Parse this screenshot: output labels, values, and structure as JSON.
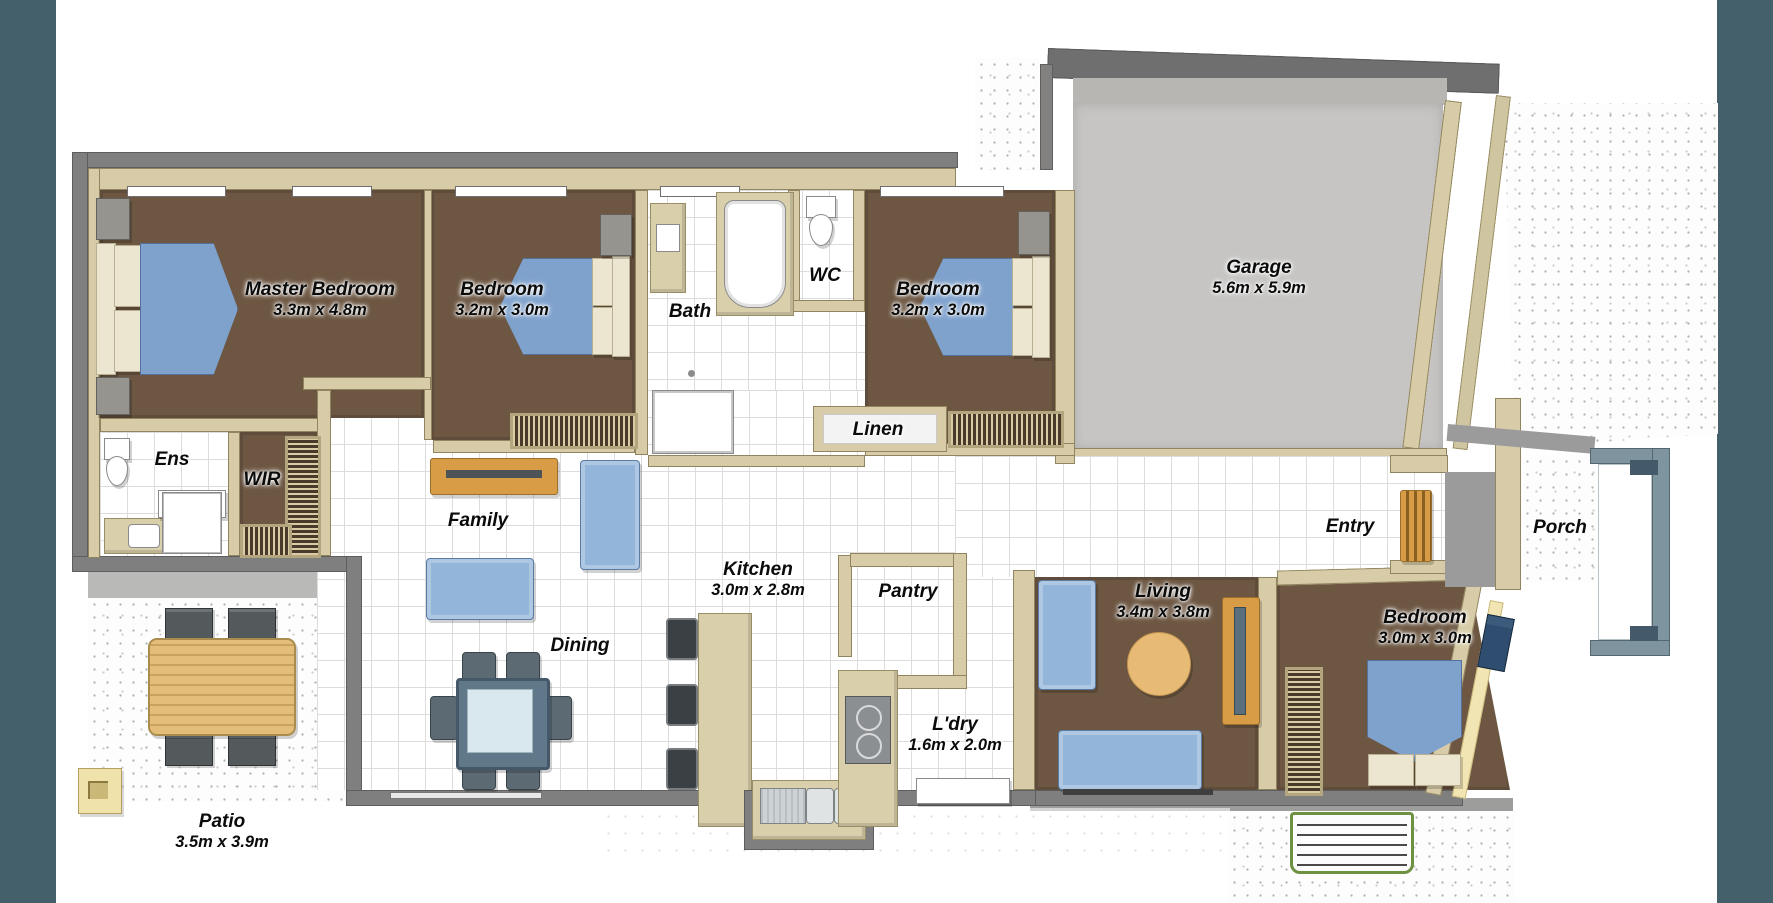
{
  "plan_title": "Single storey house floor plan",
  "rooms": [
    {
      "id": "master",
      "name": "Master Bedroom",
      "dims": "3.3m x 4.8m"
    },
    {
      "id": "bed2",
      "name": "Bedroom",
      "dims": "3.2m x 3.0m"
    },
    {
      "id": "bath",
      "name": "Bath",
      "dims": ""
    },
    {
      "id": "wc",
      "name": "WC",
      "dims": ""
    },
    {
      "id": "bed3",
      "name": "Bedroom",
      "dims": "3.2m x 3.0m"
    },
    {
      "id": "garage",
      "name": "Garage",
      "dims": "5.6m x 5.9m"
    },
    {
      "id": "ens",
      "name": "Ens",
      "dims": ""
    },
    {
      "id": "wir",
      "name": "WIR",
      "dims": ""
    },
    {
      "id": "family",
      "name": "Family",
      "dims": ""
    },
    {
      "id": "linen",
      "name": "Linen",
      "dims": ""
    },
    {
      "id": "kitchen",
      "name": "Kitchen",
      "dims": "3.0m x 2.8m"
    },
    {
      "id": "pantry",
      "name": "Pantry",
      "dims": ""
    },
    {
      "id": "entry",
      "name": "Entry",
      "dims": ""
    },
    {
      "id": "porch",
      "name": "Porch",
      "dims": ""
    },
    {
      "id": "living",
      "name": "Living",
      "dims": "3.4m x 3.8m"
    },
    {
      "id": "bed4",
      "name": "Bedroom",
      "dims": "3.0m x 3.0m"
    },
    {
      "id": "dining",
      "name": "Dining",
      "dims": ""
    },
    {
      "id": "ldry",
      "name": "L'dry",
      "dims": "1.6m x 2.0m"
    },
    {
      "id": "patio",
      "name": "Patio",
      "dims": "3.5m x 3.9m"
    }
  ],
  "colors": {
    "sidebar": "#44616b",
    "carpet": "#6d5743",
    "beigewall": "#d7cca7",
    "beigeline": "#91855f",
    "graywall": "#7f7f80",
    "garage": "#c6c5c3",
    "bedblue": "#7fa2cd",
    "sofablue": "#93b5da",
    "cream": "#ece5cf",
    "orange": "#d89b46",
    "ottoman": "#e7ba76",
    "stepgreen": "#6d9140"
  }
}
